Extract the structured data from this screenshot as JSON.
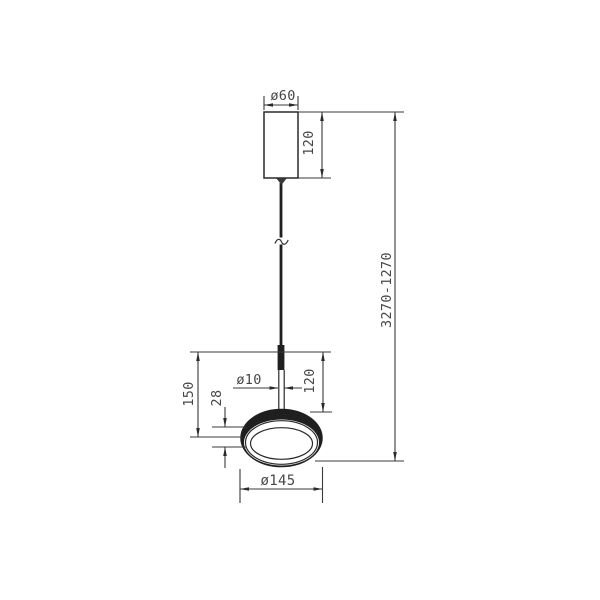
{
  "drawing": {
    "kind": "pendant-lamp-dimension-drawing",
    "dimensions": {
      "canopy_diameter": "ø60",
      "canopy_height": "120",
      "suspension_height_range": "3270-1270",
      "stem_diameter": "ø10",
      "stem_length": "120",
      "head_height": "150",
      "shade_rim_height": "28",
      "shade_diameter": "ø145"
    },
    "colors": {
      "line": "#3a3a3a",
      "object_line": "#2a2a2a",
      "dark_fill": "#1f1f1f",
      "text": "#474747",
      "background": "#ffffff"
    }
  }
}
